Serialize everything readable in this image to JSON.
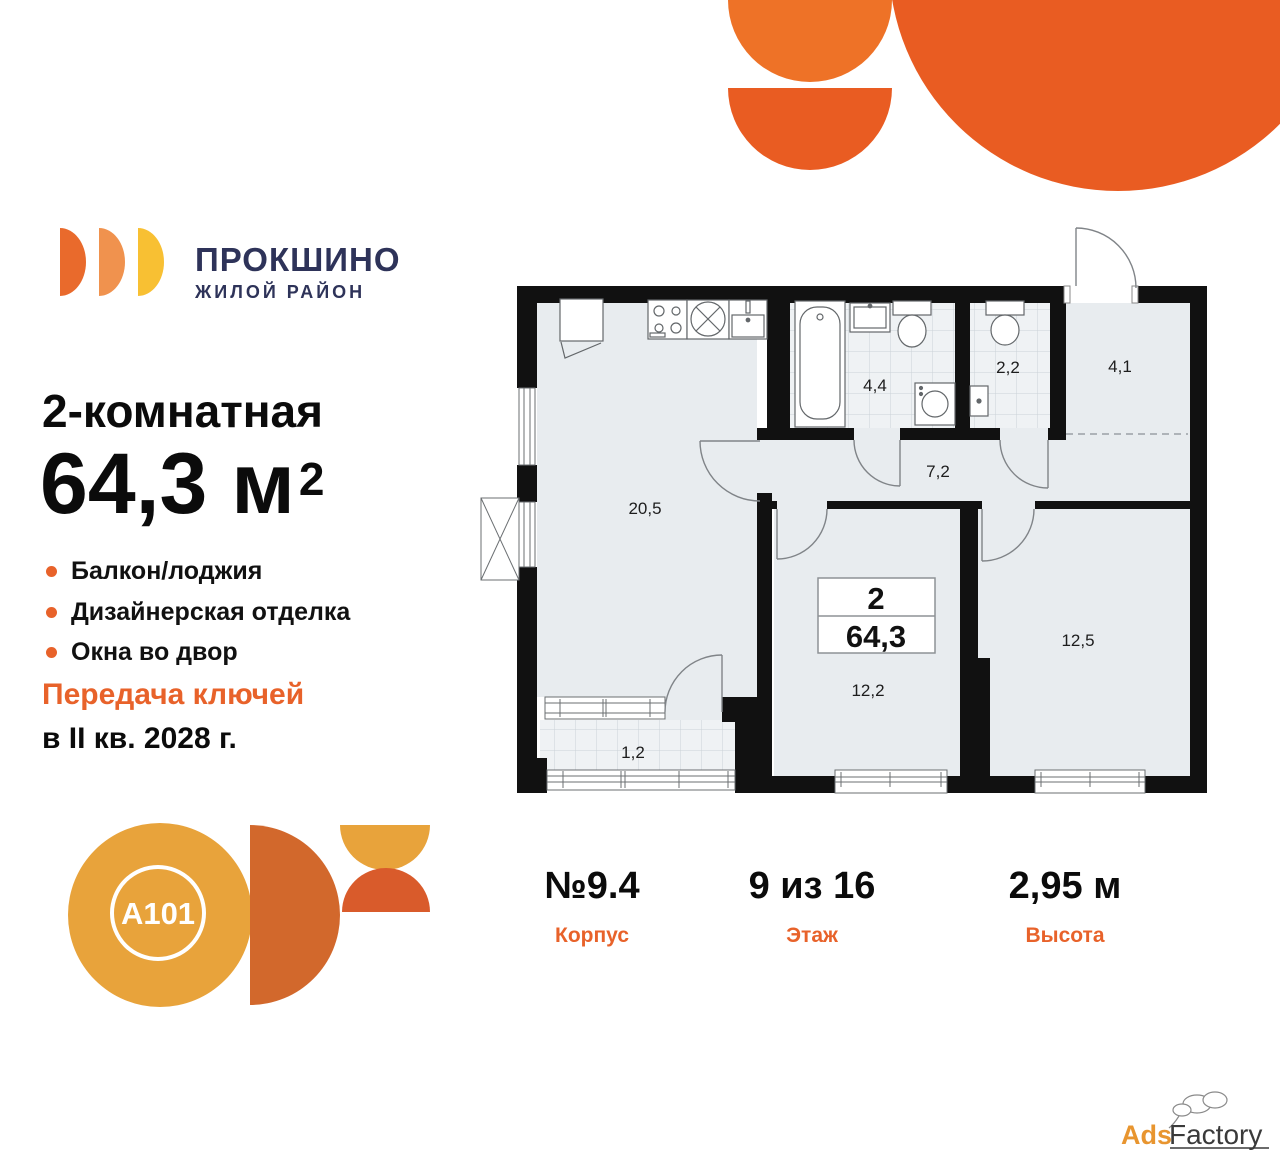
{
  "brand": {
    "name": "ПРОКШИНО",
    "tagline": "ЖИЛОЙ РАЙОН"
  },
  "listing": {
    "type": "2-комнатная",
    "area_value": "64,3 м",
    "area_sup": "2",
    "features": [
      "Балкон/лоджия",
      "Дизайнерская отделка",
      "Окна во двор"
    ],
    "handover_line1": "Передача ключей",
    "handover_line2": "в II кв. 2028 г."
  },
  "plan": {
    "labels": {
      "living": "20,5",
      "bathroom": "4,4",
      "wc": "2,2",
      "hall": "4,1",
      "corridor": "7,2",
      "bedroom1": "12,2",
      "bedroom2": "12,5",
      "balcony": "1,2"
    },
    "info_box": {
      "rooms": "2",
      "area": "64,3"
    }
  },
  "details": [
    {
      "value": "№9.4",
      "label": "Корпус"
    },
    {
      "value": "9 из 16",
      "label": "Этаж"
    },
    {
      "value": "2,95 м",
      "label": "Высота"
    }
  ],
  "developer": {
    "logo_text": "A101"
  },
  "watermark": {
    "part1": "Ads",
    "part2": "Factory"
  },
  "colors": {
    "accent_orange": "#E8622A",
    "brand_navy": "#2E3359",
    "shape_orange_light": "#EE7227",
    "shape_orange_deep": "#E95C22",
    "logo_yellow": "#F8C033",
    "logo_mid_orange": "#F0924E",
    "a101_amber": "#E8A33B",
    "a101_burnt": "#D2682C",
    "a101_red_orange": "#D95B2B",
    "plan_room_fill": "#E8ECEF",
    "plan_wall": "#111111"
  }
}
